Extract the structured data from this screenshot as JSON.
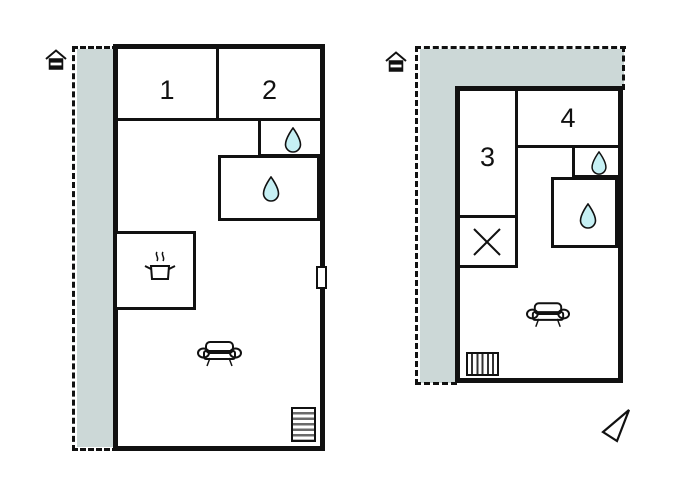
{
  "colors": {
    "wall": "#111111",
    "terrace_fill": "#ccd8d7",
    "drop_fill": "#c6f0f4",
    "stair_stripe": "#6b6b6b"
  },
  "plans": [
    {
      "name": "plan-left",
      "rooms": [
        {
          "label": "1"
        },
        {
          "label": "2"
        }
      ],
      "icons": [
        "house-entrance",
        "water-drop",
        "water-drop",
        "cooking-pot",
        "sofa",
        "stairs",
        "door-marker",
        "terrace"
      ]
    },
    {
      "name": "plan-right",
      "rooms": [
        {
          "label": "3"
        },
        {
          "label": "4"
        }
      ],
      "icons": [
        "house-entrance",
        "water-drop",
        "water-drop",
        "crossed-closet",
        "sofa",
        "radiator",
        "north-arrow",
        "terrace"
      ]
    }
  ]
}
